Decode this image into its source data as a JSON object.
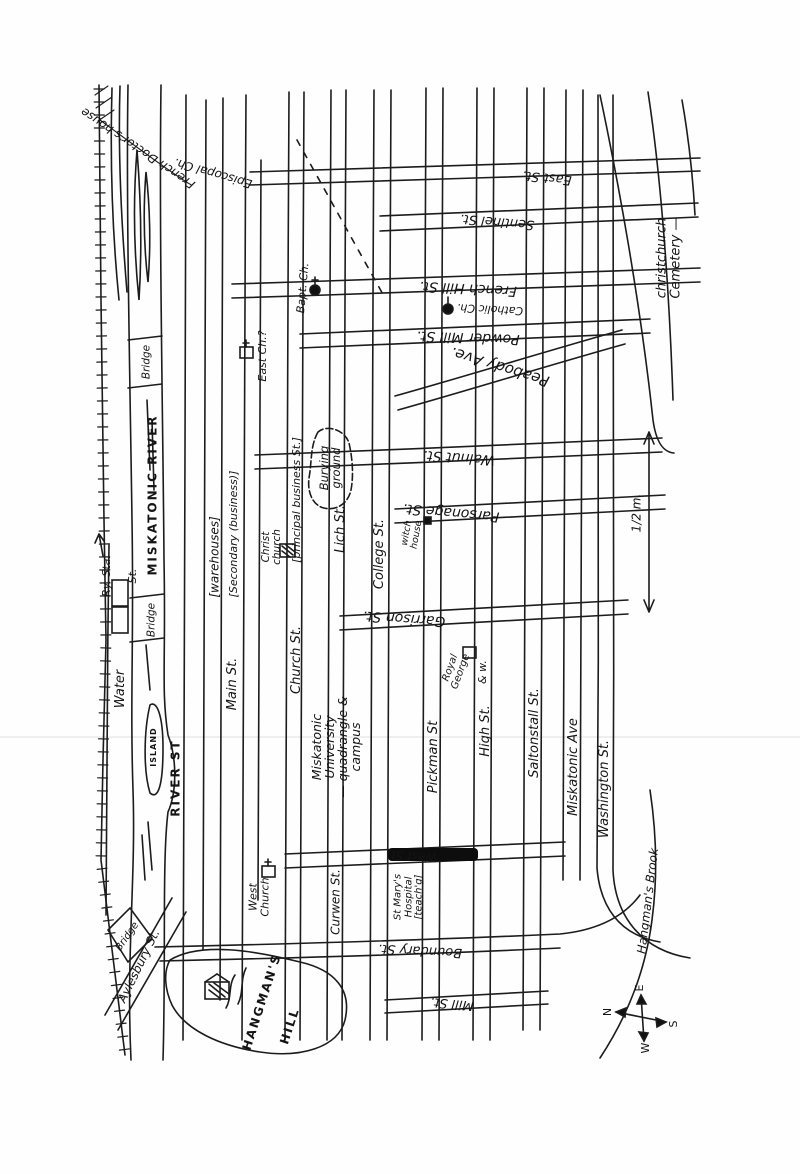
{
  "colors": {
    "ink": "#1c1c1c",
    "paper": "#fefefe"
  },
  "labels": {
    "french_doctors_house": {
      "text": "French Doctor's house"
    },
    "episcopal_ch": {
      "text": "Episcopal Ch."
    },
    "east_st": {
      "text": "East St."
    },
    "sentinel_st": {
      "text": "Sentinel St."
    },
    "french_hill_st": {
      "text": "French Hill St."
    },
    "catholic_ch": {
      "text": "Catholic Ch."
    },
    "powder_mill_st": {
      "text": "Powder Mill St."
    },
    "peabody_ave": {
      "text": "Peabody Ave."
    },
    "walnut_st": {
      "text": "Walnut St."
    },
    "parsonage_st": {
      "text": "Parsonage St."
    },
    "garrison_st": {
      "text": "Garrison St."
    },
    "west_st": {
      "text": "West St."
    },
    "boundary_st": {
      "text": "Boundary St."
    },
    "mill_st": {
      "text": "Mill St."
    },
    "ry_sta": {
      "text": "Ry. Sta."
    },
    "bridge_street": {
      "text": "St."
    },
    "water_st": {
      "text": "Water"
    },
    "miskatonic_river": {
      "text": "MISKATONIC RIVER"
    },
    "bridge_top": {
      "text": "Bridge"
    },
    "bridge_mid": {
      "text": "Bridge"
    },
    "island": {
      "text": "ISLAND"
    },
    "river_st": {
      "text": "RIVER ST"
    },
    "warehouses": {
      "text": "[warehouses]"
    },
    "main_st": {
      "text": "Main St."
    },
    "secondary_note": {
      "text": "[Secondary (business)]"
    },
    "church_st": {
      "text": "Church St."
    },
    "principal_note": {
      "text": "[principal business St.]"
    },
    "east_ch": {
      "text": "East Ch.?"
    },
    "bapt_ch": {
      "text": "Bapt. Ch."
    },
    "christ_church": {
      "text": "Christ\nchurch"
    },
    "lich_st": {
      "text": "Lich St."
    },
    "college_st": {
      "text": "College St."
    },
    "witch_house": {
      "text": "witch\nhouse"
    },
    "burying_ground": {
      "text": "Burying\nground"
    },
    "miskatonic_university": {
      "text": "Miskatonic\nUniversity\n— quadrangle &\ncampus"
    },
    "pickman_st": {
      "text": "Pickman St"
    },
    "royal_george": {
      "text": "Royal\nGeorge"
    },
    "high_st": {
      "text": "High St."
    },
    "high_st_note": {
      "text": "& w."
    },
    "saltonstall_st": {
      "text": "Saltonstall St."
    },
    "miskatonic_ave": {
      "text": "Miskatonic Ave"
    },
    "washington_st": {
      "text": "Washington St."
    },
    "hangmans_brook": {
      "text": "Hangman's Brook"
    },
    "hangmans_hill_1": {
      "text": "HANGMAN'S"
    },
    "hangmans_hill_2": {
      "text": "HILL"
    },
    "aylesbury_st": {
      "text": "Aylesbury St."
    },
    "bridge_diamond": {
      "text": "Bridge"
    },
    "st_marys_hospital": {
      "text": "St Mary's\nHospital\n[teach'g]"
    },
    "curwen_st": {
      "text": "Curwen St."
    },
    "west_church": {
      "text": "West\nChurch"
    },
    "christchurch_cemetery": {
      "text": "christchurch Cemetery —"
    },
    "scale_note": {
      "text": "1/2 m."
    }
  },
  "compass": {
    "n": "N",
    "e": "E",
    "s": "S",
    "w": "W"
  }
}
